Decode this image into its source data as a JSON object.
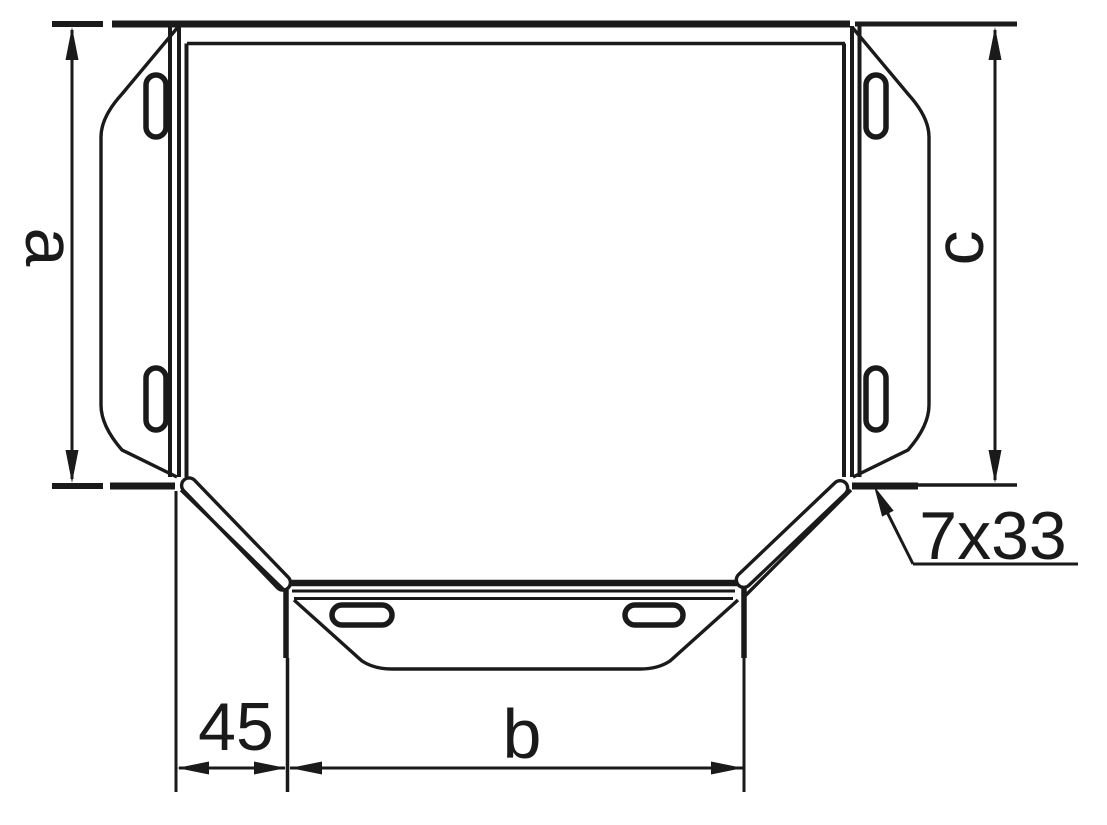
{
  "drawing": {
    "colors": {
      "line": "#1a1a1a",
      "background": "#ffffff"
    },
    "dimensions": {
      "side_width_left": "a",
      "side_width_right": "c",
      "branch_offset": "45",
      "branch_width": "b",
      "slot_size": "7x33"
    }
  }
}
